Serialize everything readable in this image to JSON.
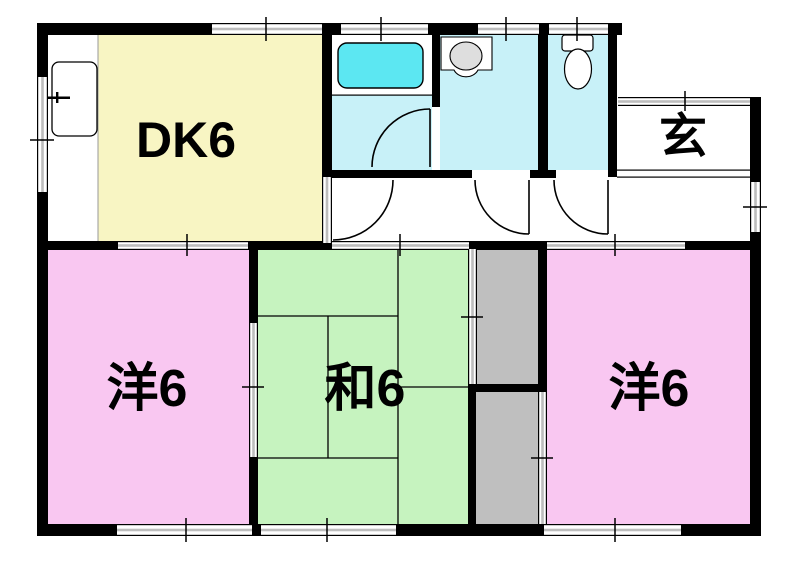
{
  "floorplan": {
    "rooms": {
      "dk": {
        "label": "DK6",
        "color": "#F8F5C3"
      },
      "entrance": {
        "label": "玄",
        "color": "#FFFFFF"
      },
      "western_left": {
        "label": "洋6",
        "color": "#F9C7F1"
      },
      "japanese": {
        "label": "和6",
        "color": "#C6F3BF"
      },
      "western_right": {
        "label": "洋6",
        "color": "#F9C7F1"
      }
    },
    "colors": {
      "wall": "#000000",
      "wet_area_floor": "#C8F1F8",
      "bathtub": "#5CE7F2",
      "closet": "#BFBFBF",
      "window_band": "#BDBDBD",
      "basin": "#DEDEDE",
      "counter_line": "#999999"
    }
  }
}
